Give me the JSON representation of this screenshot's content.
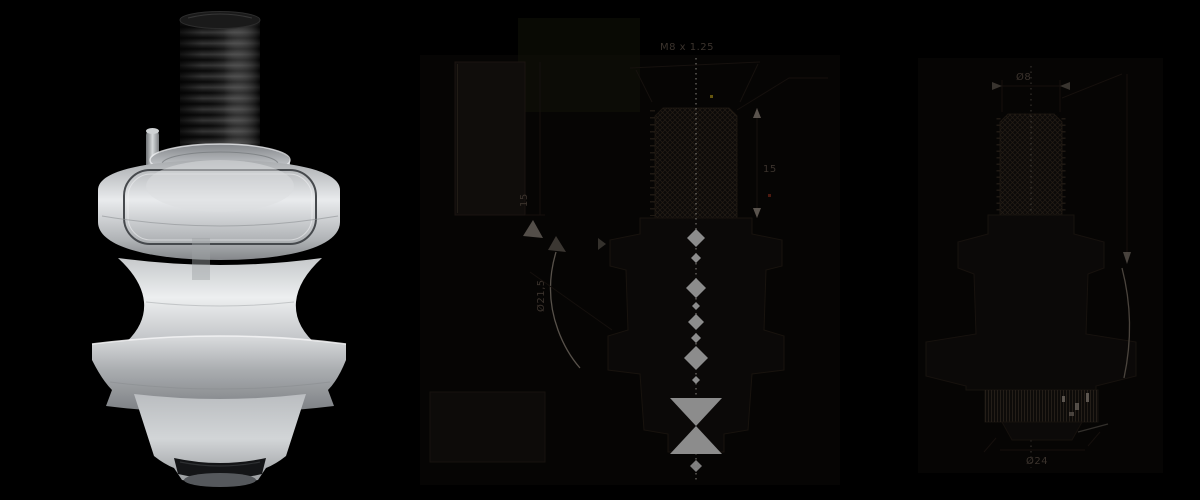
{
  "canvas": {
    "width": 1200,
    "height": 500,
    "background": "#000000"
  },
  "product_render": {
    "description": "3d-render-swingarm-spool",
    "engraving": "02-1-10",
    "colors": {
      "stud_black": "#161616",
      "body_silver": "#c9ccd0",
      "highlight_silver": "#eceeef",
      "oring_black": "#141517"
    }
  },
  "technical_drawing": {
    "stroke_color": "#18130e",
    "accent_gray": "#8a8a8a",
    "text_color": "#3b332d",
    "labels": {
      "thread_spec": "M8 x 1.25",
      "thread_length": "15",
      "profile_height": "15",
      "profile_waist_dia": "Ø21,5",
      "section_thread_dia": "Ø8",
      "section_base_dia": "Ø24"
    }
  }
}
